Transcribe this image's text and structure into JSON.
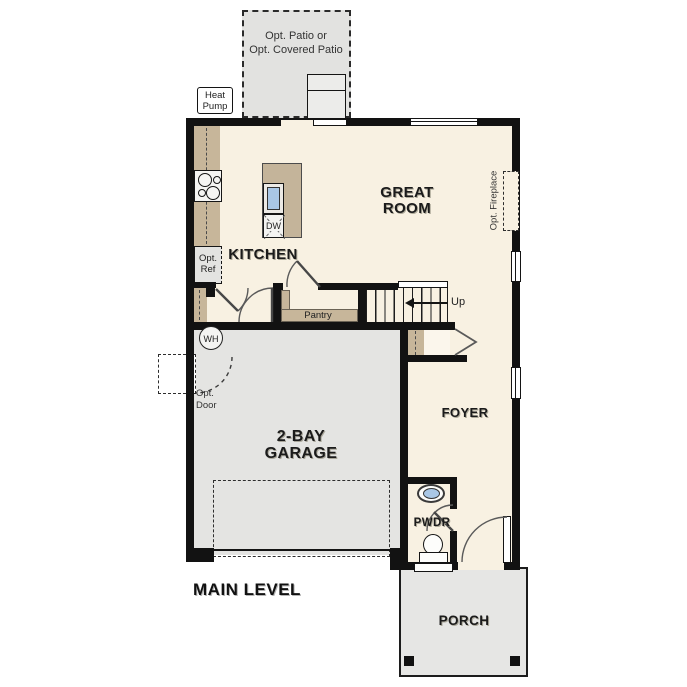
{
  "plan": {
    "title": "MAIN LEVEL",
    "rooms": {
      "great_room": {
        "line1": "GREAT",
        "line2": "ROOM"
      },
      "kitchen": {
        "label": "KITCHEN"
      },
      "garage": {
        "line1": "2-BAY",
        "line2": "GARAGE"
      },
      "foyer": {
        "label": "FOYER"
      },
      "pwdr": {
        "label": "PWDR"
      },
      "porch": {
        "label": "PORCH"
      },
      "pantry": {
        "label": "Pantry"
      }
    },
    "annotations": {
      "opt_patio_line1": "Opt. Patio or",
      "opt_patio_line2": "Opt. Covered Patio",
      "heat_pump_line1": "Heat",
      "heat_pump_line2": "Pump",
      "opt_ref_line1": "Opt.",
      "opt_ref_line2": "Ref",
      "opt_door_line1": "Opt.",
      "opt_door_line2": "Door",
      "opt_fireplace": "Opt. Fireplace",
      "stairs_up": "Up",
      "water_heater": "WH",
      "dishwasher": "DW"
    },
    "colors": {
      "wall": "#121212",
      "floor_cream": "#f8f1e2",
      "garage_gray": "#e4e4e2",
      "patio_gray": "#e2e2e0",
      "cabinet_tan": "#c7b69a",
      "sink_blue": "#a9c7e6"
    }
  }
}
